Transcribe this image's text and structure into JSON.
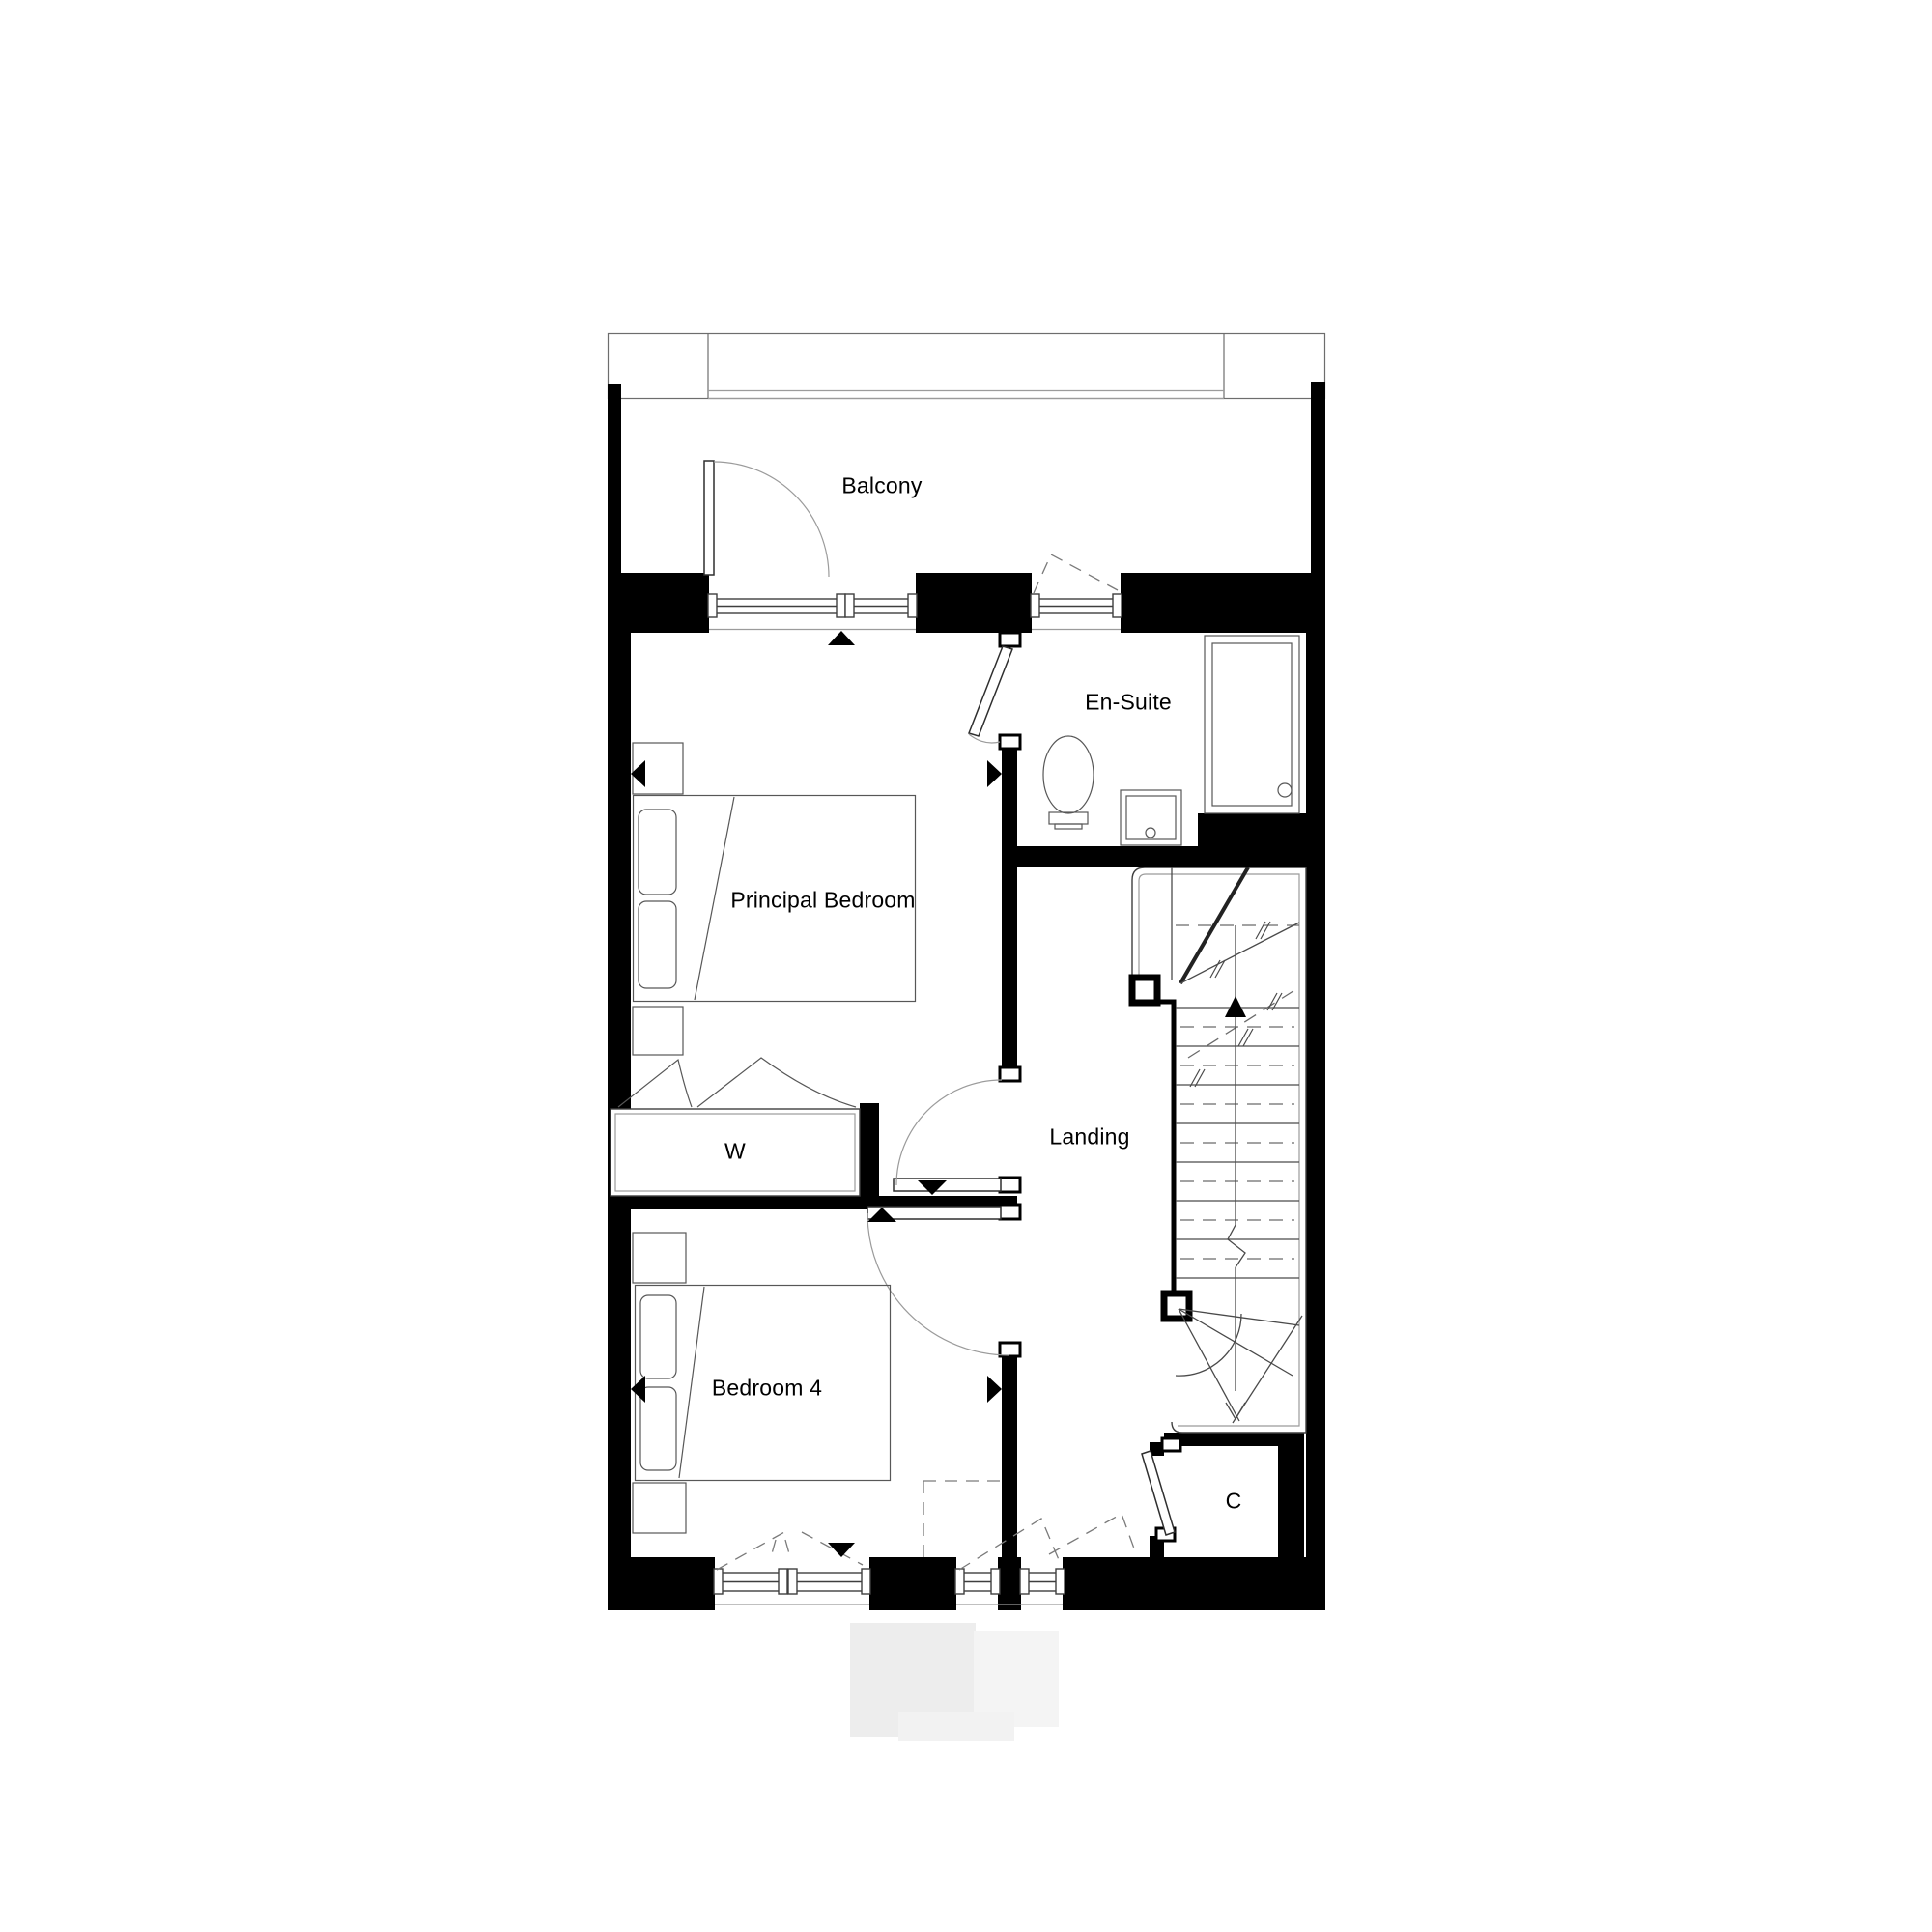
{
  "page": {
    "background": "#ffffff"
  },
  "floorplan": {
    "type": "architectural-floor-plan",
    "rooms": [
      {
        "id": "balcony",
        "label": "Balcony"
      },
      {
        "id": "en_suite",
        "label": "En-Suite"
      },
      {
        "id": "principal_bedroom",
        "label": "Principal Bedroom"
      },
      {
        "id": "landing",
        "label": "Landing"
      },
      {
        "id": "wardrobe",
        "label": "W"
      },
      {
        "id": "bedroom_4",
        "label": "Bedroom 4"
      },
      {
        "id": "cupboard",
        "label": "C"
      }
    ],
    "colors": {
      "wall": "#000000",
      "line": "#3f3f3f",
      "light_line": "#9b9b9b",
      "dashed_line": "#7a7a7a",
      "text": "#000000",
      "watermark": "#ededed"
    },
    "symbols": [
      "door-swing-arc",
      "direction-arrow",
      "stair-up-arrow",
      "window-glazing",
      "shower-tray",
      "toilet",
      "wash-basin",
      "double-bed",
      "wardrobe-hanging",
      "staircase"
    ]
  }
}
